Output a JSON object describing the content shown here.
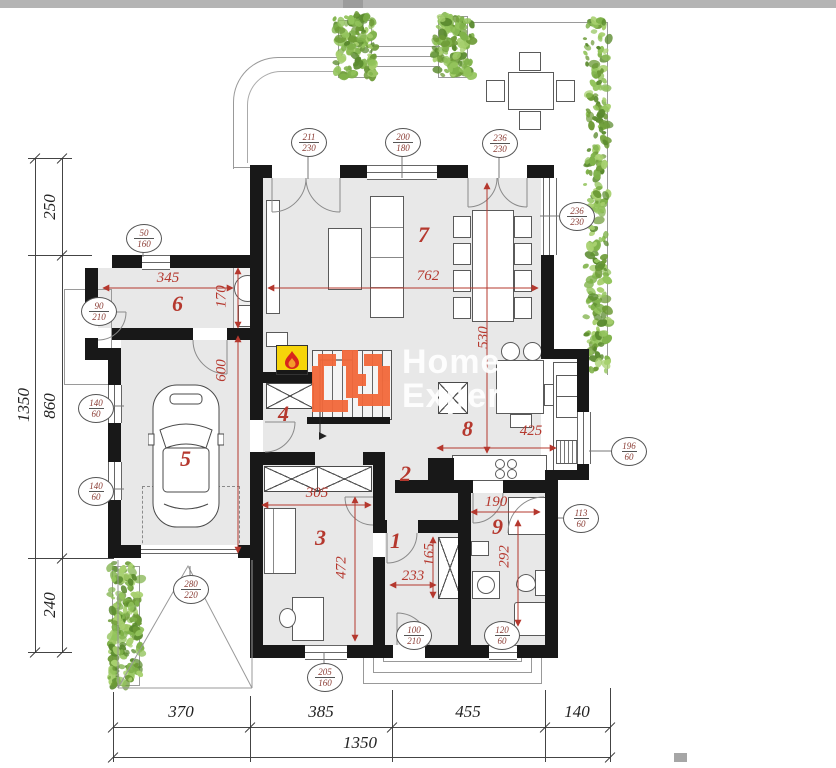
{
  "watermark": {
    "line1": "Home",
    "line2": "Expert"
  },
  "rooms": [
    "1",
    "2",
    "3",
    "4",
    "5",
    "6",
    "7",
    "8",
    "9"
  ],
  "dims": {
    "d345": "345",
    "d170": "170",
    "d600": "600",
    "d762": "762",
    "d530": "530",
    "d425": "425",
    "d305": "305",
    "d472": "472",
    "d233": "233",
    "d165": "165",
    "d190": "190",
    "d292": "292"
  },
  "labels": [
    {
      "w": "211",
      "h": "230"
    },
    {
      "w": "200",
      "h": "180"
    },
    {
      "w": "236",
      "h": "230"
    },
    {
      "w": "236",
      "h": "230"
    },
    {
      "w": "50",
      "h": "160"
    },
    {
      "w": "90",
      "h": "210"
    },
    {
      "w": "140",
      "h": "60"
    },
    {
      "w": "140",
      "h": "60"
    },
    {
      "w": "280",
      "h": "220"
    },
    {
      "w": "205",
      "h": "160"
    },
    {
      "w": "100",
      "h": "210"
    },
    {
      "w": "120",
      "h": "60"
    },
    {
      "w": "196",
      "h": "60"
    },
    {
      "w": "113",
      "h": "60"
    }
  ],
  "outer": {
    "left_total": "1350",
    "left_segments": [
      "250",
      "860",
      "240"
    ],
    "bottom_segments": [
      "370",
      "385",
      "455",
      "140"
    ],
    "bottom_total": "1350"
  },
  "colors": {
    "wall": "#181818",
    "floor": "#e8e8e8",
    "dimension_red": "#b5382e",
    "label_maroon": "#8a3b33",
    "plant_green": "#7fb24a",
    "brand_orange": "#f2683a",
    "fireplace_yellow": "#f6d40a",
    "flame_red": "#d8251c"
  },
  "icons": {
    "fireplace": "flame-icon",
    "car": "car-top-view-icon",
    "plants": "foliage",
    "logo": "home-expert-logo"
  }
}
